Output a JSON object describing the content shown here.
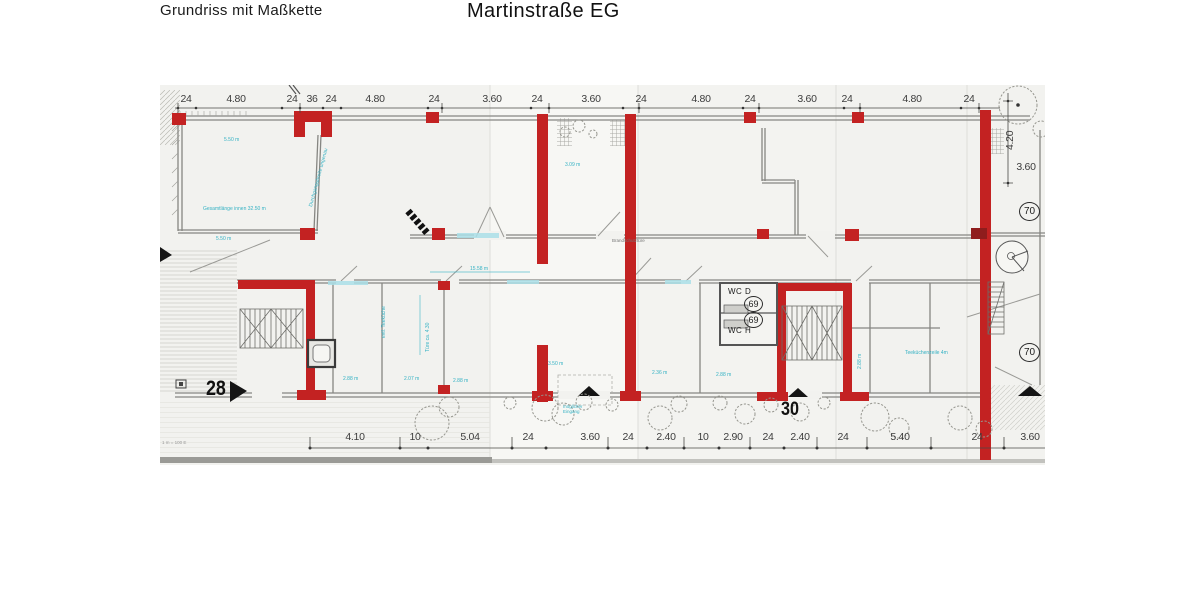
{
  "header": {
    "subtitle": "Grundriss  mit Maßkette",
    "title": "Martinstraße  EG"
  },
  "dims": {
    "top": [
      "24",
      "4.80",
      "24",
      "36",
      "24",
      "4.80",
      "24",
      "3.60",
      "24",
      "3.60",
      "24",
      "4.80",
      "24",
      "3.60",
      "24",
      "4.80",
      "24"
    ],
    "bottom": [
      "4.10",
      "10",
      "5.04",
      "24",
      "3.60",
      "24",
      "2.40",
      "10",
      "2.90",
      "24",
      "2.40",
      "24",
      "5.40",
      "24",
      "3.60"
    ],
    "right_vertical": "4.20",
    "right_room": "3.60"
  },
  "labels": {
    "house_left": "28",
    "house_right": "30",
    "wc_top": "WC D",
    "wc_bottom": "WC H",
    "room_69_top": "69",
    "room_69_bottom": "69",
    "room_70_top": "70",
    "room_70_bottom": "70",
    "fire_door": "Brandschutztüre",
    "scale_note": "1 m = 100 E"
  },
  "annotations": {
    "left_room_width_top": "5.50 m",
    "left_room_total": "Gesamtlänge innen 32.50 m",
    "left_room_width_bottom": "5.50 m",
    "passage": "Durchgangsbreite ungenau",
    "center_room": "3.09 m",
    "corridor": "15.58 m",
    "tea_kitchen": "evtl. Teeküche",
    "door_width": "Türe ca. 4.30",
    "room_a": "2.88 m",
    "room_b": "2.07 m",
    "room_c": "2.88 m",
    "entry_width": "3.50 m",
    "room_d": "2.36 m",
    "room_e": "2.88 m",
    "possible_entry": "möglicher Eingang",
    "tea_line": "Teeküchenzeile 4m",
    "room_f": "2.88 m"
  },
  "colors": {
    "wall_red": "#c32222",
    "annotation_cyan": "#35b2c4",
    "line_gray": "#868682"
  }
}
